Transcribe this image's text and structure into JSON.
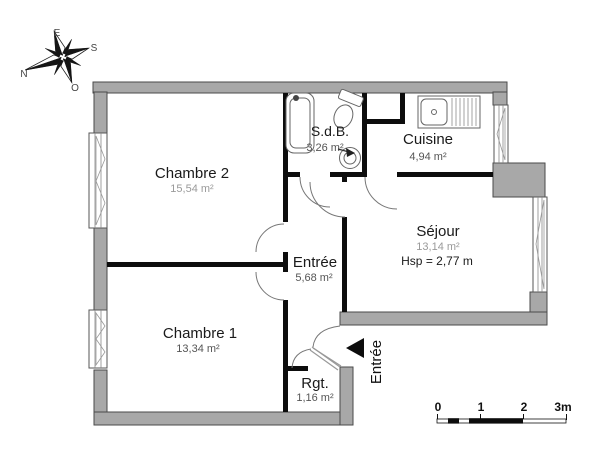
{
  "compass": {
    "n": "N",
    "e": "E",
    "s": "S",
    "o": "O"
  },
  "rooms": [
    {
      "id": "chambre2",
      "name": "Chambre 2",
      "area": "15,54 m²"
    },
    {
      "id": "sdb",
      "name": "S.d.B.",
      "area": "3,26 m²"
    },
    {
      "id": "cuisine",
      "name": "Cuisine",
      "area": "4,94 m²"
    },
    {
      "id": "sejour",
      "name": "Séjour",
      "area": "13,14 m²",
      "ceiling_height": "Hsp = 2,77 m"
    },
    {
      "id": "entree",
      "name": "Entrée",
      "area": "5,68 m²"
    },
    {
      "id": "chambre1",
      "name": "Chambre 1",
      "area": "13,34 m²"
    },
    {
      "id": "rgt",
      "name": "Rgt.",
      "area": "1,16 m²"
    }
  ],
  "entrance_label": "Entrée",
  "scale_bar": {
    "t0": "0",
    "t1": "1",
    "t2": "2",
    "t3": "3m"
  },
  "colors": {
    "exterior_wall": "#a8a8a8",
    "interior_wall": "#0d0d0d"
  }
}
